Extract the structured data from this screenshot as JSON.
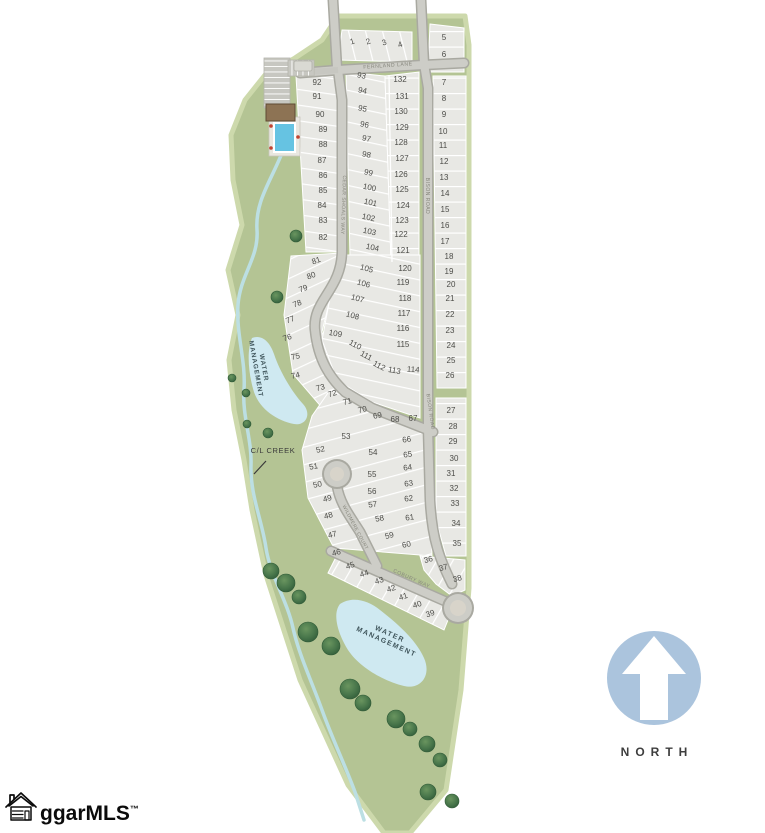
{
  "north_indicator": {
    "label": "NORTH"
  },
  "logo": {
    "text": "ggarMLS",
    "tm": "™"
  },
  "map": {
    "street_labels": [
      {
        "text": "FERNLAND LANE",
        "x": 388,
        "y": 67,
        "r": -4,
        "size": 5.2,
        "ls": 0.5
      },
      {
        "text": "CEDAR SHOALS WAY",
        "x": 342,
        "y": 205,
        "r": 92,
        "size": 5.0,
        "ls": 0.5
      },
      {
        "text": "BISON ROAD",
        "x": 426,
        "y": 196,
        "r": 90,
        "size": 5.0,
        "ls": 0.5
      },
      {
        "text": "BISON ROAD",
        "x": 429,
        "y": 412,
        "r": 82,
        "size": 5.0,
        "ls": 0.5
      },
      {
        "text": "WILDMERE COURT",
        "x": 354,
        "y": 528,
        "r": 62,
        "size": 4.8,
        "ls": 0.4
      },
      {
        "text": "COBURY WAY",
        "x": 411,
        "y": 580,
        "r": 24,
        "size": 5.2,
        "ls": 0.5
      }
    ],
    "area_labels": [
      {
        "lines": [
          "WATER",
          "MANAGEMENT"
        ],
        "x": 262,
        "y": 368,
        "r": 80,
        "size": 6.5,
        "ls": 1.0,
        "cls": "area-label"
      },
      {
        "lines": [
          "WATER",
          "MANAGEMENT"
        ],
        "x": 389,
        "y": 636,
        "r": 24,
        "size": 7.0,
        "ls": 1.4,
        "cls": "area-label"
      },
      {
        "lines": [
          "C/L CREEK"
        ],
        "x": 273,
        "y": 453,
        "r": 0,
        "size": 7.5,
        "ls": 0.6,
        "cls": "creek-label"
      }
    ],
    "lots": [
      [
        1,
        353,
        44,
        -18
      ],
      [
        2,
        369,
        44,
        -18
      ],
      [
        3,
        385,
        45,
        -18
      ],
      [
        4,
        401,
        47,
        -20
      ],
      [
        5,
        444,
        40,
        0
      ],
      [
        6,
        444,
        57,
        0
      ],
      [
        7,
        444,
        85,
        0
      ],
      [
        8,
        444,
        101,
        0
      ],
      [
        9,
        444,
        117,
        0
      ],
      [
        10,
        443,
        134,
        0
      ],
      [
        11,
        443,
        148,
        0
      ],
      [
        12,
        444,
        164,
        0
      ],
      [
        13,
        444,
        180,
        0
      ],
      [
        14,
        445,
        196,
        0
      ],
      [
        15,
        445,
        212,
        0
      ],
      [
        16,
        445,
        228,
        0
      ],
      [
        17,
        445,
        244,
        0
      ],
      [
        18,
        449,
        259,
        0
      ],
      [
        19,
        449,
        274,
        0
      ],
      [
        20,
        451,
        287,
        0
      ],
      [
        21,
        450,
        301,
        0
      ],
      [
        22,
        450,
        317,
        0
      ],
      [
        23,
        450,
        333,
        0
      ],
      [
        24,
        451,
        348,
        0
      ],
      [
        25,
        451,
        363,
        0
      ],
      [
        26,
        450,
        378,
        0
      ],
      [
        27,
        451,
        413,
        0
      ],
      [
        28,
        453,
        429,
        0
      ],
      [
        29,
        453,
        444,
        0
      ],
      [
        30,
        454,
        461,
        0
      ],
      [
        31,
        451,
        476,
        0
      ],
      [
        32,
        454,
        491,
        0
      ],
      [
        33,
        455,
        506,
        0
      ],
      [
        34,
        456,
        526,
        0
      ],
      [
        35,
        457,
        546,
        0
      ],
      [
        36,
        429,
        562,
        -15
      ],
      [
        37,
        444,
        570,
        -15
      ],
      [
        38,
        458,
        581,
        -15
      ],
      [
        39,
        431,
        616,
        -18
      ],
      [
        40,
        418,
        607,
        -18
      ],
      [
        41,
        404,
        599,
        -18
      ],
      [
        42,
        392,
        591,
        -18
      ],
      [
        43,
        380,
        583,
        -18
      ],
      [
        44,
        365,
        576,
        -18
      ],
      [
        45,
        351,
        568,
        -18
      ],
      [
        46,
        337,
        555,
        -15
      ],
      [
        47,
        333,
        537,
        -15
      ],
      [
        48,
        329,
        518,
        -15
      ],
      [
        49,
        328,
        501,
        -15
      ],
      [
        50,
        318,
        487,
        -12
      ],
      [
        51,
        314,
        469,
        -10
      ],
      [
        52,
        321,
        452,
        -12
      ],
      [
        53,
        346,
        439,
        0
      ],
      [
        54,
        373,
        455,
        0
      ],
      [
        55,
        372,
        477,
        0
      ],
      [
        56,
        372,
        494,
        0
      ],
      [
        57,
        373,
        507,
        -8
      ],
      [
        58,
        380,
        521,
        -10
      ],
      [
        59,
        390,
        538,
        -15
      ],
      [
        60,
        407,
        547,
        -12
      ],
      [
        61,
        410,
        520,
        -8
      ],
      [
        62,
        409,
        501,
        -8
      ],
      [
        63,
        409,
        486,
        -8
      ],
      [
        64,
        408,
        470,
        -8
      ],
      [
        65,
        408,
        457,
        -8
      ],
      [
        66,
        407,
        442,
        -8
      ],
      [
        67,
        413,
        421,
        0
      ],
      [
        68,
        395,
        422,
        0
      ],
      [
        69,
        378,
        418,
        -12
      ],
      [
        70,
        363,
        412,
        -14
      ],
      [
        71,
        348,
        404,
        -14
      ],
      [
        72,
        333,
        396,
        -16
      ],
      [
        73,
        321,
        390,
        -14
      ],
      [
        74,
        296,
        378,
        -12
      ],
      [
        75,
        296,
        359,
        -12
      ],
      [
        76,
        288,
        340,
        -18
      ],
      [
        77,
        291,
        322,
        -20
      ],
      [
        78,
        298,
        306,
        -20
      ],
      [
        79,
        304,
        291,
        -20
      ],
      [
        80,
        312,
        278,
        -20
      ],
      [
        81,
        317,
        263,
        -20
      ],
      [
        82,
        323,
        240,
        0
      ],
      [
        83,
        323,
        223,
        0
      ],
      [
        84,
        322,
        208,
        0
      ],
      [
        85,
        323,
        193,
        0
      ],
      [
        86,
        323,
        178,
        0
      ],
      [
        87,
        322,
        163,
        0
      ],
      [
        88,
        323,
        147,
        0
      ],
      [
        89,
        323,
        132,
        0
      ],
      [
        90,
        320,
        117,
        0
      ],
      [
        91,
        317,
        99,
        0
      ],
      [
        92,
        317,
        85,
        0
      ],
      [
        93,
        361,
        78,
        12
      ],
      [
        94,
        362,
        93,
        12
      ],
      [
        95,
        362,
        111,
        12
      ],
      [
        96,
        364,
        127,
        12
      ],
      [
        97,
        366,
        141,
        12
      ],
      [
        98,
        366,
        157,
        12
      ],
      [
        99,
        368,
        175,
        12
      ],
      [
        100,
        369,
        190,
        12
      ],
      [
        101,
        370,
        205,
        12
      ],
      [
        102,
        368,
        220,
        12
      ],
      [
        103,
        369,
        234,
        12
      ],
      [
        104,
        372,
        250,
        12
      ],
      [
        105,
        366,
        271,
        15
      ],
      [
        106,
        363,
        286,
        15
      ],
      [
        107,
        357,
        301,
        15
      ],
      [
        108,
        352,
        318,
        15
      ],
      [
        109,
        335,
        336,
        10
      ],
      [
        110,
        354,
        347,
        28
      ],
      [
        111,
        365,
        358,
        28
      ],
      [
        112,
        378,
        368,
        28
      ],
      [
        113,
        394,
        373,
        10
      ],
      [
        114,
        413,
        372,
        5
      ],
      [
        115,
        403,
        347,
        0
      ],
      [
        116,
        403,
        331,
        0
      ],
      [
        117,
        404,
        316,
        0
      ],
      [
        118,
        405,
        301,
        0
      ],
      [
        119,
        403,
        285,
        0
      ],
      [
        120,
        405,
        271,
        0
      ],
      [
        121,
        403,
        253,
        0
      ],
      [
        122,
        401,
        237,
        0
      ],
      [
        123,
        402,
        223,
        0
      ],
      [
        124,
        403,
        208,
        0
      ],
      [
        125,
        402,
        192,
        0
      ],
      [
        126,
        401,
        177,
        0
      ],
      [
        127,
        402,
        161,
        0
      ],
      [
        128,
        401,
        145,
        0
      ],
      [
        129,
        402,
        130,
        0
      ],
      [
        130,
        401,
        114,
        0
      ],
      [
        131,
        402,
        99,
        0
      ],
      [
        132,
        400,
        82,
        0
      ]
    ],
    "trees": [
      [
        296,
        236,
        6
      ],
      [
        277,
        297,
        6
      ],
      [
        232,
        378,
        4
      ],
      [
        246,
        393,
        4
      ],
      [
        247,
        424,
        4
      ],
      [
        268,
        433,
        5
      ],
      [
        271,
        571,
        8
      ],
      [
        286,
        583,
        9
      ],
      [
        299,
        597,
        7
      ],
      [
        308,
        632,
        10
      ],
      [
        331,
        646,
        9
      ],
      [
        350,
        689,
        10
      ],
      [
        363,
        703,
        8
      ],
      [
        396,
        719,
        9
      ],
      [
        410,
        729,
        7
      ],
      [
        427,
        744,
        8
      ],
      [
        440,
        760,
        7
      ],
      [
        428,
        792,
        8
      ],
      [
        452,
        801,
        7
      ]
    ],
    "colors": {
      "site_green": "#b4c494",
      "green_edge": "#cdd9ac",
      "lot_fill": "#e8e8e4",
      "road_fill": "#cdcdc7",
      "road_edge": "#a9a9a1",
      "pond_blue": "#cfe9f1",
      "creek_blue": "#bcdfe3",
      "tree_green": "#47754a",
      "north_blue": "#abc4dd",
      "building_brown": "#8d7354",
      "pool_blue": "#66c3e2"
    }
  }
}
